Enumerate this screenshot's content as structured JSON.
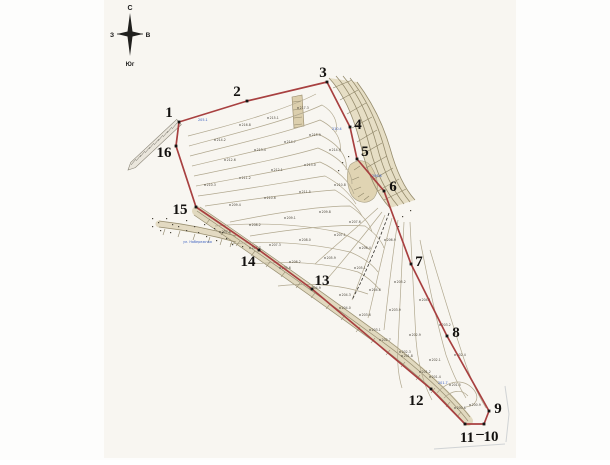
{
  "palette": {
    "paper": "#f8f6f1",
    "contour": "#b1a88f",
    "fan": "#958b6c",
    "hachure": "#8e8568",
    "boundary": "#a84040",
    "marker": "#171513",
    "blue": "#3b5fbf",
    "band_fill": "#ddd3b6",
    "artifact": "#aeb6bd"
  },
  "compass": {
    "north": "С",
    "west": "З",
    "east": "В",
    "south": "Юг"
  },
  "street_label": {
    "text": "ул. Набережная",
    "x": 183,
    "y": 243
  },
  "blue_spots": [
    {
      "x": 198,
      "y": 121,
      "text": "205.1"
    },
    {
      "x": 332,
      "y": 130,
      "text": "210.4"
    },
    {
      "x": 372,
      "y": 177,
      "text": "206.8"
    },
    {
      "x": 438,
      "y": 384,
      "text": "201.7"
    }
  ],
  "boundary": {
    "vertices": [
      {
        "n": "1",
        "x": 179,
        "y": 122,
        "lx": 169,
        "ly": 112
      },
      {
        "n": "2",
        "x": 247,
        "y": 101,
        "lx": 237,
        "ly": 91
      },
      {
        "n": "3",
        "x": 327,
        "y": 82,
        "lx": 323,
        "ly": 72
      },
      {
        "n": "4",
        "x": 350,
        "y": 127,
        "lx": 358,
        "ly": 124
      },
      {
        "n": "5",
        "x": 357,
        "y": 159,
        "lx": 365,
        "ly": 151
      },
      {
        "n": "6",
        "x": 384,
        "y": 191,
        "lx": 393,
        "ly": 186
      },
      {
        "n": "7",
        "x": 411,
        "y": 264,
        "lx": 419,
        "ly": 261
      },
      {
        "n": "8",
        "x": 447,
        "y": 336,
        "lx": 456,
        "ly": 332
      },
      {
        "n": "9",
        "x": 489,
        "y": 411,
        "lx": 498,
        "ly": 408
      },
      {
        "n": "10",
        "x": 484,
        "y": 424,
        "lx": 491,
        "ly": 436
      },
      {
        "n": "11",
        "x": 465,
        "y": 424,
        "lx": 467,
        "ly": 437
      },
      {
        "n": "12",
        "x": 431,
        "y": 389,
        "lx": 416,
        "ly": 400
      },
      {
        "n": "13",
        "x": 312,
        "y": 289,
        "lx": 322,
        "ly": 280
      },
      {
        "n": "14",
        "x": 259,
        "y": 250,
        "lx": 248,
        "ly": 261
      },
      {
        "n": "15",
        "x": 196,
        "y": 207,
        "lx": 180,
        "ly": 209
      },
      {
        "n": "16",
        "x": 176,
        "y": 146,
        "lx": 164,
        "ly": 152
      }
    ],
    "extra_labels": [
      {
        "text": "–",
        "x": 480,
        "y": 433
      }
    ]
  },
  "road": {
    "poly": "181.3,124.6 135.3,167.6 128,170 130.7,162.4 176.7,119.4",
    "ticks": [
      [
        177,
        123,
        172,
        129
      ],
      [
        172,
        127,
        167,
        133
      ],
      [
        168,
        131,
        163,
        137
      ],
      [
        163,
        135,
        158,
        141
      ],
      [
        159,
        139,
        154,
        145
      ],
      [
        154,
        143,
        149,
        149
      ],
      [
        150,
        147,
        145,
        153
      ],
      [
        145,
        151,
        140,
        157
      ],
      [
        141,
        155,
        136,
        161
      ],
      [
        136,
        159,
        131,
        165
      ]
    ]
  },
  "terrain": {
    "fills": [
      {
        "d": "M329,78 C345,95 355,120 362,150 C368,175 378,195 390,208 L415,200 C404,188 396,170 390,148 C383,124 372,102 357,82 Z",
        "fill": "#e0d5b6",
        "o": 0.75
      },
      {
        "d": "M350,165 C358,158 368,160 372,168 C378,178 380,190 374,198 C366,206 354,202 350,192 C347,184 346,172 350,165 Z",
        "fill": "#dccfa9",
        "stroke": "#9b9173",
        "o": 0.85
      },
      {
        "d": "M292,97 L302,95 L304,126 L294,128 Z",
        "fill": "#d9cba6",
        "stroke": "#8b7d5a",
        "o": 0.9
      }
    ],
    "bands": [
      {
        "d": "M197,211 C250,247 320,296 380,340 C420,369 451,399 468,421",
        "stroke": "#ddd3b6",
        "w": 10,
        "o": 0.85
      },
      {
        "d": "M159,224 C185,227 211,232 236,239",
        "stroke": "#ddd3b6",
        "w": 7,
        "o": 0.8
      }
    ],
    "band_edges": [
      "M200,207 C253,243 322,292 382,336 C421,365 453,395 470,417",
      "M194,215 C247,251 317,300 377,344 C417,373 448,403 465,425",
      "M197,211 C250,247 320,296 380,340 C420,369 451,399 468,421",
      "M159,221 C185,224 211,229 236,236",
      "M159,227 C185,230 211,235 236,242"
    ],
    "fan": [
      "M329,78 C345,95 355,120 362,150 C368,175 378,195 390,208",
      "M336,76 C352,94 363,120 370,148 C376,172 386,192 398,206",
      "M343,76 C359,95 370,120 377,146 C383,170 393,190 404,204",
      "M350,78 C366,98 377,122 384,147 C390,170 399,189 410,202",
      "M357,82 C372,102 383,124 390,148 C396,170 404,188 415,200"
    ],
    "contours": [
      "M188,136 C235,124 285,110 316,94",
      "M189,146 C240,132 290,120 322,105 C334,112 338,122 336,132",
      "M190,156 C245,142 288,132 320,120 C336,128 342,140 340,152",
      "M192,166 C250,152 290,144 318,134 C340,144 348,158 346,170",
      "M194,176 C252,164 292,156 318,148 C342,158 352,172 352,184",
      "M196,186 C250,176 295,168 320,162 C338,170 350,182 354,194",
      "M198,196 C255,188 298,180 325,176 C340,184 350,194 356,204",
      "M205,206 C260,198 305,192 335,190 C348,198 358,208 362,216",
      "M230,222 C280,212 320,206 350,206 C362,214 370,224 372,232",
      "M250,236 C300,228 340,224 365,226 C376,234 382,242 384,248",
      "M215,226 C260,222 300,224 338,232 C352,237 363,244 370,250",
      "M230,244 C275,240 315,244 350,252 C362,257 372,264 378,272",
      "M252,264 C295,260 330,264 358,272 C368,277 375,284 380,290",
      "M278,286 C315,282 345,286 368,294",
      "M385,215 C370,250 360,280 352,300",
      "M392,218 C382,255 375,290 368,318",
      "M398,220 C392,258 388,295 384,330",
      "M404,222 C402,262 400,300 398,345 C397,360 398,375 402,388",
      "M410,222 C412,262 414,300 416,340 C418,365 424,385 432,400",
      "M382,212 C360,240 342,262 328,278",
      "M378,208 C352,232 330,250 315,264",
      "M420,240 C428,280 436,320 446,355 C452,372 458,385 466,398",
      "M430,250 C442,290 454,330 466,365 C472,382 478,395 486,408",
      "M437,393 C448,380 464,378 474,390 C480,398 476,406 466,407",
      "M444,398 C452,390 462,389 468,396"
    ],
    "hachures": [
      [
        333,
        88,
        352,
        80
      ],
      [
        340,
        100,
        358,
        90
      ],
      [
        347,
        114,
        366,
        103
      ],
      [
        352,
        128,
        372,
        117
      ],
      [
        357,
        142,
        377,
        130
      ],
      [
        361,
        155,
        382,
        143
      ],
      [
        366,
        168,
        387,
        156
      ],
      [
        372,
        180,
        393,
        168
      ],
      [
        378,
        191,
        399,
        179
      ],
      [
        384,
        200,
        406,
        189
      ],
      [
        210,
        219,
        206,
        224
      ],
      [
        225,
        230,
        221,
        235
      ],
      [
        240,
        241,
        236,
        246
      ],
      [
        255,
        251,
        251,
        256
      ],
      [
        270,
        262,
        266,
        267
      ],
      [
        285,
        272,
        281,
        277
      ],
      [
        300,
        283,
        296,
        288
      ],
      [
        315,
        293,
        311,
        298
      ],
      [
        330,
        304,
        326,
        309
      ],
      [
        345,
        315,
        341,
        320
      ],
      [
        360,
        327,
        356,
        332
      ],
      [
        375,
        338,
        371,
        343
      ],
      [
        390,
        350,
        386,
        355
      ],
      [
        405,
        362,
        401,
        367
      ],
      [
        420,
        375,
        416,
        380
      ],
      [
        435,
        388,
        431,
        393
      ],
      [
        450,
        402,
        446,
        407
      ],
      [
        461,
        412,
        457,
        417
      ],
      [
        293,
        102,
        301,
        101
      ],
      [
        293,
        110,
        302,
        109
      ],
      [
        294,
        118,
        302,
        117
      ],
      [
        294,
        125,
        302,
        124
      ],
      [
        354,
        170,
        360,
        166
      ],
      [
        352,
        180,
        359,
        177
      ],
      [
        354,
        190,
        361,
        187
      ],
      [
        358,
        197,
        364,
        193
      ],
      [
        364,
        200,
        369,
        196
      ],
      [
        165,
        229,
        163,
        235
      ],
      [
        180,
        231,
        178,
        237
      ],
      [
        195,
        234,
        193,
        240
      ],
      [
        210,
        237,
        208,
        243
      ],
      [
        222,
        239,
        220,
        245
      ],
      [
        232,
        241,
        230,
        247
      ]
    ],
    "specks": [
      [
        152,
        218
      ],
      [
        158,
        222
      ],
      [
        166,
        218
      ],
      [
        172,
        224
      ],
      [
        186,
        220
      ],
      [
        204,
        224
      ],
      [
        214,
        228
      ],
      [
        152,
        226
      ],
      [
        160,
        230
      ],
      [
        170,
        232
      ],
      [
        186,
        230
      ],
      [
        198,
        232
      ],
      [
        206,
        236
      ],
      [
        216,
        240
      ],
      [
        226,
        238
      ],
      [
        232,
        244
      ],
      [
        242,
        246
      ],
      [
        178,
        226
      ],
      [
        194,
        226
      ],
      [
        222,
        232
      ],
      [
        348,
        156
      ],
      [
        342,
        162
      ],
      [
        338,
        170
      ],
      [
        410,
        210
      ],
      [
        402,
        216
      ],
      [
        398,
        226
      ]
    ],
    "dashed": [
      "M389,213 C380,238 370,262 360,284 L352,300"
    ],
    "artifacts": [
      "M505,386 L509,414 L506,442",
      "M434,449 L505,444"
    ]
  },
  "spot_elevations": [
    {
      "x": 215,
      "y": 140,
      "v": "214.2"
    },
    {
      "x": 240,
      "y": 125,
      "v": "216.8"
    },
    {
      "x": 268,
      "y": 118,
      "v": "215.1"
    },
    {
      "x": 298,
      "y": 108,
      "v": "217.3"
    },
    {
      "x": 225,
      "y": 160,
      "v": "212.6"
    },
    {
      "x": 255,
      "y": 150,
      "v": "213.4"
    },
    {
      "x": 285,
      "y": 142,
      "v": "214.7"
    },
    {
      "x": 310,
      "y": 135,
      "v": "215.9"
    },
    {
      "x": 205,
      "y": 185,
      "v": "210.3"
    },
    {
      "x": 240,
      "y": 178,
      "v": "211.2"
    },
    {
      "x": 272,
      "y": 170,
      "v": "212.1"
    },
    {
      "x": 305,
      "y": 165,
      "v": "213.0"
    },
    {
      "x": 230,
      "y": 205,
      "v": "209.4"
    },
    {
      "x": 265,
      "y": 198,
      "v": "210.6"
    },
    {
      "x": 300,
      "y": 192,
      "v": "211.5"
    },
    {
      "x": 330,
      "y": 150,
      "v": "214.9"
    },
    {
      "x": 335,
      "y": 185,
      "v": "210.8"
    },
    {
      "x": 250,
      "y": 225,
      "v": "208.2"
    },
    {
      "x": 285,
      "y": 218,
      "v": "209.1"
    },
    {
      "x": 320,
      "y": 212,
      "v": "209.8"
    },
    {
      "x": 350,
      "y": 222,
      "v": "207.6"
    },
    {
      "x": 270,
      "y": 245,
      "v": "207.3"
    },
    {
      "x": 300,
      "y": 240,
      "v": "208.0"
    },
    {
      "x": 335,
      "y": 235,
      "v": "207.1"
    },
    {
      "x": 360,
      "y": 248,
      "v": "206.4"
    },
    {
      "x": 290,
      "y": 262,
      "v": "206.2"
    },
    {
      "x": 325,
      "y": 258,
      "v": "205.9"
    },
    {
      "x": 355,
      "y": 268,
      "v": "205.1"
    },
    {
      "x": 385,
      "y": 240,
      "v": "206.9"
    },
    {
      "x": 340,
      "y": 295,
      "v": "204.3"
    },
    {
      "x": 370,
      "y": 290,
      "v": "204.8"
    },
    {
      "x": 395,
      "y": 282,
      "v": "205.2"
    },
    {
      "x": 360,
      "y": 315,
      "v": "203.6"
    },
    {
      "x": 390,
      "y": 310,
      "v": "203.9"
    },
    {
      "x": 420,
      "y": 300,
      "v": "204.1"
    },
    {
      "x": 380,
      "y": 340,
      "v": "202.7"
    },
    {
      "x": 410,
      "y": 335,
      "v": "202.9"
    },
    {
      "x": 440,
      "y": 325,
      "v": "203.2"
    },
    {
      "x": 402,
      "y": 356,
      "v": "201.8"
    },
    {
      "x": 430,
      "y": 360,
      "v": "202.1"
    },
    {
      "x": 455,
      "y": 355,
      "v": "202.4"
    },
    {
      "x": 420,
      "y": 372,
      "v": "201.2"
    },
    {
      "x": 450,
      "y": 385,
      "v": "201.5"
    },
    {
      "x": 470,
      "y": 405,
      "v": "200.9"
    },
    {
      "x": 455,
      "y": 408,
      "v": "200.6"
    },
    {
      "x": 220,
      "y": 232,
      "v": "207.8"
    },
    {
      "x": 250,
      "y": 248,
      "v": "206.7"
    },
    {
      "x": 280,
      "y": 268,
      "v": "205.6"
    },
    {
      "x": 310,
      "y": 288,
      "v": "204.9"
    },
    {
      "x": 340,
      "y": 308,
      "v": "204.0"
    },
    {
      "x": 370,
      "y": 330,
      "v": "203.1"
    },
    {
      "x": 400,
      "y": 352,
      "v": "202.3"
    },
    {
      "x": 430,
      "y": 377,
      "v": "201.4"
    }
  ]
}
